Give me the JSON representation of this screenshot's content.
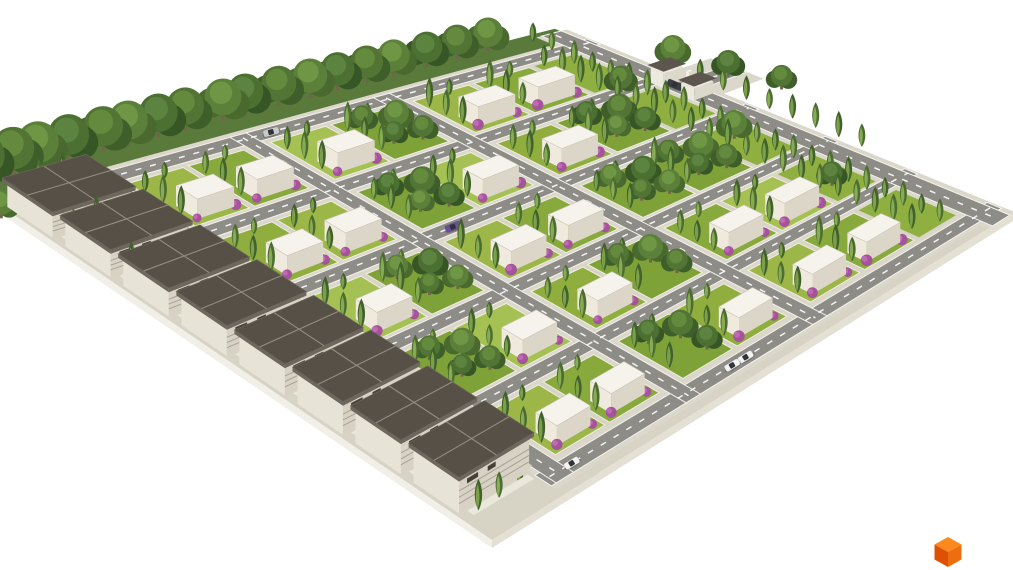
{
  "labels": {
    "scene_description": "Aerial 3D render of a gated residential subdivision: a diamond-shaped site with a back tree line, a left row of two-story dark-roofed villas, a grid of white model homes on landscaped lots with cypress trees and purple flowering shrubs, tree-lined asphalt streets with dashed lane markings, a right-side green buffer, an entrance gate at the top right, parked cars, and an orange cube logo in the bottom-right corner."
  },
  "palette": {
    "background": "#ffffff",
    "base": "#d7d3c5",
    "platform_sw": "#f1efe7",
    "platform_se": "#e4e1d4",
    "hedge": "#5a7a3c",
    "sidewalk": "#dbd7ca",
    "asphalt": "#8e8c87",
    "road_edge": "#f4f3ee",
    "road_dash": "#ffffff",
    "driveway": "#cfccc0",
    "lot_wall": "#efede3",
    "lawns": [
      "#9cb748",
      "#8fae3e",
      "#a6c153",
      "#88a93c"
    ],
    "lawn_wooded": "#7fa238",
    "buffer_grass": "#8fb040",
    "house": {
      "top": "#f6f3ec",
      "left": "#efeadd",
      "front": "#dcd6c8",
      "edge": "#c9c4b5"
    },
    "villa": {
      "wall_left": "#e8e3d7",
      "wall_front": "#d8d2c4",
      "roof": "#575047",
      "roof_edge": "#6e675d",
      "roof_line": "#948c80",
      "louver": "#a8a194",
      "window": "#44403a",
      "deck": "#eae7db"
    },
    "gate": {
      "wall_left": "#eceade",
      "wall_front": "#dcd9cc",
      "roof": "#5d564e",
      "post": "#f2f0e8"
    },
    "tree_sets": [
      [
        "#3e5e2a",
        "#527434",
        "#648a3e"
      ],
      [
        "#49692f",
        "#5b8039",
        "#6f9644"
      ],
      [
        "#375626",
        "#4b7031",
        "#5d8340"
      ]
    ],
    "trunk": "#74634a",
    "cypress_dark": "#42612c",
    "cypress_light": "#7ba04a",
    "cypress_dark2": "#4c6c31",
    "cypress_light2": "#86ab52",
    "shrub": "#a5539b",
    "shrub_hi": "#c06ab4",
    "car_colors": {
      "white": "#f2f2f0",
      "orange": "#d96a2b",
      "yellow": "#e7c735",
      "purple": "#6a4f9e",
      "dark": "#3a3d42",
      "silver": "#c9c9c7"
    },
    "car_glass": "#30343a",
    "car_shadow": "rgba(40,40,35,0.22)"
  },
  "site": {
    "corners": {
      "w": [
        -30,
        185
      ],
      "t": [
        565,
        30
      ],
      "e": [
        1013,
        213
      ],
      "s": [
        492,
        540
      ]
    },
    "u_len": 660,
    "v_len": 620,
    "platform_depth": 8
  },
  "hedge_band": {
    "u0": -40,
    "v0": -8,
    "u1": 655,
    "v1": 26
  },
  "back_trees": {
    "v": 2,
    "u_from": -56,
    "u_to": 600,
    "step": 33,
    "r_near": 25,
    "r_far": 16
  },
  "lone_tree": {
    "u": -14,
    "v": 52,
    "r": 14
  },
  "rows": [
    {
      "type": "road",
      "v": 30,
      "w": 18
    },
    {
      "type": "lots",
      "v": 54,
      "d": 82
    },
    {
      "type": "road",
      "v": 140,
      "w": 18
    },
    {
      "type": "lots",
      "v": 164,
      "d": 82
    },
    {
      "type": "road",
      "v": 250,
      "w": 18
    },
    {
      "type": "lots",
      "v": 274,
      "d": 82
    },
    {
      "type": "road",
      "v": 360,
      "w": 18
    },
    {
      "type": "lots",
      "v": 384,
      "d": 82
    },
    {
      "type": "road",
      "v": 470,
      "w": 18
    },
    {
      "type": "lots",
      "v": 494,
      "d": 82
    },
    {
      "type": "road",
      "v": 584,
      "w": 20
    }
  ],
  "columns": [
    {
      "type": "lot",
      "u": 126,
      "w": 62
    },
    {
      "type": "lot",
      "u": 194,
      "w": 62
    },
    {
      "type": "road",
      "u": 262,
      "w": 18
    },
    {
      "type": "lot",
      "u": 286,
      "w": 62
    },
    {
      "type": "lot",
      "u": 354,
      "w": 62
    },
    {
      "type": "road",
      "u": 422,
      "w": 18
    },
    {
      "type": "lot",
      "u": 446,
      "w": 62
    },
    {
      "type": "lot",
      "u": 514,
      "w": 62
    },
    {
      "type": "buffer",
      "u": 582,
      "w": 46
    }
  ],
  "villa_road": {
    "u": 98,
    "w": 22,
    "v0": 26,
    "v1": 604
  },
  "ne_road": {
    "u": 634,
    "w": 22,
    "v0": 0,
    "v1": 620
  },
  "entrance": {
    "stub": {
      "sidewalk": [
        660,
        144,
        708,
        218
      ],
      "asphalt": [
        660,
        168,
        708,
        194
      ],
      "dash_v": 181
    },
    "pavilions": [
      {
        "u": 634,
        "v": 150,
        "w": 22,
        "d": 18,
        "h": 14
      },
      {
        "u": 634,
        "v": 192,
        "w": 22,
        "d": 18,
        "h": 12
      }
    ],
    "posts": [
      {
        "u": 658,
        "v": 170
      },
      {
        "u": 658,
        "v": 188
      }
    ]
  },
  "wooded_lots": [
    [
      0,
      3
    ],
    [
      1,
      2
    ],
    [
      1,
      5
    ],
    [
      2,
      1
    ],
    [
      2,
      4
    ],
    [
      2,
      5
    ],
    [
      3,
      0
    ],
    [
      3,
      3
    ],
    [
      4,
      2
    ]
  ],
  "villas": {
    "u0": 4,
    "w": 88,
    "v_start": 40,
    "spacing": 69,
    "depth": 54,
    "count": 8,
    "gap_cypress_u": [
      20,
      46,
      72
    ]
  },
  "buffer_planting": {
    "row1_u": 588,
    "row2_u": 612,
    "v_from": 60,
    "v_to": 570,
    "step": 25,
    "trees": [
      [
        600,
        150,
        13
      ],
      [
        604,
        300,
        14
      ],
      [
        598,
        440,
        12
      ]
    ]
  },
  "outer_planting": {
    "cypress_u": 666,
    "v_from": 180,
    "v_to": 430,
    "step": 32,
    "trees": [
      [
        676,
        130,
        14
      ],
      [
        690,
        190,
        13
      ],
      [
        702,
        250,
        12
      ]
    ],
    "top_inner": [
      [
        618,
        8
      ],
      [
        618,
        34
      ]
    ]
  },
  "cars": [
    {
      "color": "white",
      "road": "villa",
      "pos": 150
    },
    {
      "color": "orange",
      "road": "villa",
      "pos": 253
    },
    {
      "color": "yellow",
      "road": "villa",
      "pos": 330
    },
    {
      "color": "orange",
      "road": "villa",
      "pos": 350
    },
    {
      "color": "purple",
      "road": "villa",
      "pos": 424
    },
    {
      "color": "orange",
      "road": "villa",
      "pos": 446
    },
    {
      "color": "white",
      "road": "se",
      "pos": 330
    },
    {
      "color": "white",
      "road": "se",
      "pos": 347
    },
    {
      "color": "white",
      "road": "se",
      "pos": 128
    },
    {
      "color": "dark",
      "road": "ne",
      "pos": 170
    },
    {
      "color": "silver",
      "road": "ne",
      "pos": 196
    },
    {
      "color": "purple",
      "road": "mid",
      "pos": 310
    },
    {
      "color": "silver",
      "road": "back",
      "pos": 300
    }
  ],
  "logo": {
    "cx": 948,
    "cy": 552,
    "hw": 13.5,
    "hh": 7.5,
    "vh": 15,
    "top": "#fa8a1e",
    "left": "#dc5106",
    "right": "#ee6d0e"
  }
}
